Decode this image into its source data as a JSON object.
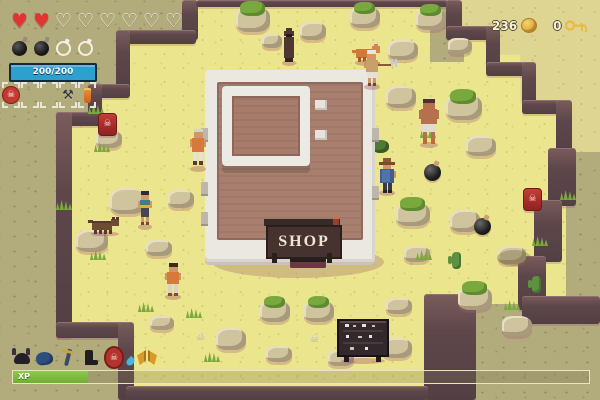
{
  "game_hud": {
    "hearts": {
      "filled": 2,
      "total": 8
    },
    "bombs": {
      "filled": 2,
      "total": 4
    },
    "health": {
      "label": "200/200"
    },
    "currency": {
      "coins": "236",
      "keys": "0"
    },
    "xp": {
      "label": "XP",
      "percent": 13
    },
    "hotbar": {
      "slot1_icon": "skull-emblem",
      "slot4_icon": "axe",
      "slot5_icon": "orange-potion"
    },
    "equipment": {
      "icons": [
        "horned-helmet",
        "blue-tunic",
        "sword",
        "boot",
        "skull-shield",
        "water-drop",
        "golden-wings"
      ]
    }
  },
  "world": {
    "shop_sign": "SHOP"
  },
  "glyphs": {
    "heart_filled": "♥",
    "heart_empty": "♡",
    "skull": "☠",
    "axe": "⚒"
  },
  "colors": {
    "sand": "#ebe68d",
    "plateau": "#b2ab7c",
    "plateau_light": "#ded593",
    "cliff": "#5e474b",
    "hp_bar_blue": "#2f9fce",
    "xp_green": "#74b637",
    "heart_red": "#e23430",
    "coin_gold": "#e9bc4a",
    "shop_roof": "#a87f6e",
    "shop_wall": "#ebe8e1",
    "barrel_red": "#b23530"
  }
}
